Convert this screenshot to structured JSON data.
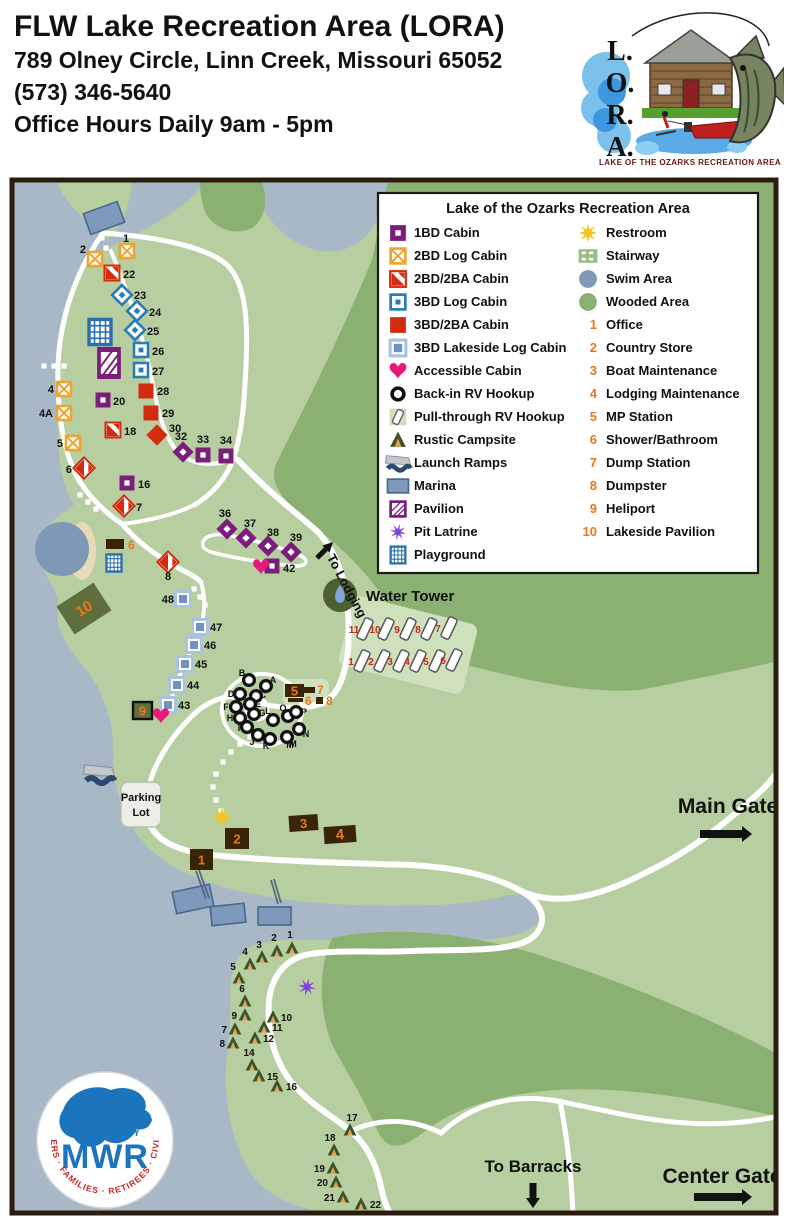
{
  "header": {
    "title": "FLW Lake Recreation Area (LORA)",
    "address": "789 Olney Circle, Linn Creek, Missouri 65052",
    "phone": "(573) 346-5640",
    "hours": "Office Hours Daily 9am - 5pm"
  },
  "lora_logo": {
    "letters": [
      "L.",
      "O.",
      "R.",
      "A."
    ],
    "caption": "LAKE OF THE OZARKS RECREATION AREA"
  },
  "mwr_logo": {
    "org": "U.S. ARMY",
    "name": "MWR",
    "ring_text": "SOLDIERS · FAMILIES · RETIREES · CIVILIANS"
  },
  "colors": {
    "land": "#b7cea0",
    "wooded": "#8bb172",
    "water": "#a8b8c6",
    "road": "#ffffff",
    "purple": "#7b1e7b",
    "orange": "#eda431",
    "red": "#d32b0e",
    "blue": "#2a7cb5",
    "lakeside_frame": "#a9c3e0",
    "lakeside_fill": "#6e93c3",
    "heart": "#e91878",
    "building": "#3a2408",
    "orange_num": "#ee7518",
    "red_num": "#c5281c",
    "olive": "#5e6e3c",
    "sun": "#f3c41d",
    "latrine": "#8040d8",
    "play_blue": "#2d6fae",
    "tower_green": "#4e6033",
    "drop": "#7fa8d8",
    "tent_green": "#3a5326",
    "tent_door": "#e8a05a",
    "pad": "#cfe0bc",
    "beach": "#e8d9b8",
    "swim": "#7d99b5",
    "dock": "#7d99bb"
  },
  "legend": {
    "title": "Lake of the Ozarks Recreation Area",
    "symbols_left": [
      {
        "icon": "cabin-1bd",
        "label": "1BD Cabin"
      },
      {
        "icon": "cabin-2bd",
        "label": "2BD Log Cabin"
      },
      {
        "icon": "cabin-2bd2ba",
        "label": "2BD/2BA Cabin"
      },
      {
        "icon": "cabin-3bd",
        "label": "3BD Log Cabin"
      },
      {
        "icon": "cabin-3bd2ba",
        "label": "3BD/2BA Cabin"
      },
      {
        "icon": "cabin-lakeside",
        "label": "3BD Lakeside Log Cabin"
      },
      {
        "icon": "accessible",
        "label": "Accessible Cabin"
      },
      {
        "icon": "rv-backin",
        "label": "Back-in RV Hookup"
      },
      {
        "icon": "rv-pullthrough",
        "label": "Pull-through RV Hookup"
      },
      {
        "icon": "tent",
        "label": "Rustic Campsite"
      },
      {
        "icon": "launch",
        "label": "Launch Ramps"
      },
      {
        "icon": "marina",
        "label": "Marina"
      },
      {
        "icon": "pavilion",
        "label": "Pavilion"
      },
      {
        "icon": "latrine",
        "label": "Pit Latrine"
      },
      {
        "icon": "playground",
        "label": "Playground"
      }
    ],
    "symbols_right": [
      {
        "icon": "restroom",
        "label": "Restroom"
      },
      {
        "icon": "stairway",
        "label": "Stairway"
      },
      {
        "icon": "swim",
        "label": "Swim Area"
      },
      {
        "icon": "wooded",
        "label": "Wooded Area"
      }
    ],
    "numbered": [
      {
        "n": "1",
        "label": "Office"
      },
      {
        "n": "2",
        "label": "Country Store"
      },
      {
        "n": "3",
        "label": "Boat Maintenance"
      },
      {
        "n": "4",
        "label": "Lodging Maintenance"
      },
      {
        "n": "5",
        "label": "MP Station"
      },
      {
        "n": "6",
        "label": "Shower/Bathroom"
      },
      {
        "n": "7",
        "label": "Dump Station"
      },
      {
        "n": "8",
        "label": "Dumpster"
      },
      {
        "n": "9",
        "label": "Heliport"
      },
      {
        "n": "10",
        "label": "Lakeside Pavilion"
      }
    ]
  },
  "map": {
    "cabins": [
      {
        "n": "1",
        "t": "2bd",
        "x": 127,
        "y": 251,
        "r": 0,
        "lx": 126,
        "ly": 242,
        "la": "middle"
      },
      {
        "n": "2",
        "t": "2bd",
        "x": 95,
        "y": 259,
        "r": 0,
        "lx": 86,
        "ly": 253,
        "la": "end"
      },
      {
        "n": "4",
        "t": "2bd",
        "x": 64,
        "y": 389,
        "r": 0,
        "lx": 54,
        "ly": 393,
        "la": "end"
      },
      {
        "n": "4A",
        "t": "2bd",
        "x": 64,
        "y": 413,
        "r": 0,
        "lx": 53,
        "ly": 417,
        "la": "end"
      },
      {
        "n": "5",
        "t": "2bd",
        "x": 73,
        "y": 443,
        "r": 0,
        "lx": 63,
        "ly": 447,
        "la": "end"
      },
      {
        "n": "22",
        "t": "2bd2ba",
        "x": 112,
        "y": 273,
        "r": 0,
        "lx": 123,
        "ly": 278
      },
      {
        "n": "18",
        "t": "2bd2ba",
        "x": 113,
        "y": 430,
        "r": 0,
        "lx": 124,
        "ly": 435
      },
      {
        "n": "6",
        "t": "2bd2ba",
        "x": 84,
        "y": 468,
        "r": 45,
        "lx": 72,
        "ly": 473,
        "la": "end"
      },
      {
        "n": "7",
        "t": "2bd2ba",
        "x": 124,
        "y": 506,
        "r": 45,
        "lx": 136,
        "ly": 511
      },
      {
        "n": "8",
        "t": "2bd2ba",
        "x": 168,
        "y": 562,
        "r": 45,
        "lx": 168,
        "ly": 580,
        "la": "middle"
      },
      {
        "n": "23",
        "t": "3bd",
        "x": 122,
        "y": 295,
        "r": 45,
        "lx": 134,
        "ly": 299
      },
      {
        "n": "24",
        "t": "3bd",
        "x": 137,
        "y": 311,
        "r": 45,
        "lx": 149,
        "ly": 316
      },
      {
        "n": "25",
        "t": "3bd",
        "x": 135,
        "y": 330,
        "r": 45,
        "lx": 147,
        "ly": 335
      },
      {
        "n": "26",
        "t": "3bd",
        "x": 141,
        "y": 350,
        "r": 0,
        "lx": 152,
        "ly": 355
      },
      {
        "n": "27",
        "t": "3bd",
        "x": 141,
        "y": 370,
        "r": 0,
        "lx": 152,
        "ly": 375
      },
      {
        "n": "28",
        "t": "3bd2ba",
        "x": 146,
        "y": 391,
        "r": 0,
        "lx": 157,
        "ly": 395
      },
      {
        "n": "29",
        "t": "3bd2ba",
        "x": 151,
        "y": 413,
        "r": 0,
        "lx": 162,
        "ly": 417
      },
      {
        "n": "30",
        "t": "3bd2ba",
        "x": 157,
        "y": 435,
        "r": 45,
        "lx": 169,
        "ly": 432
      },
      {
        "n": "20",
        "t": "1bd",
        "x": 103,
        "y": 400,
        "r": 0,
        "lx": 113,
        "ly": 405
      },
      {
        "n": "16",
        "t": "1bd",
        "x": 127,
        "y": 483,
        "r": 0,
        "lx": 138,
        "ly": 488
      },
      {
        "n": "32",
        "t": "1bd",
        "x": 183,
        "y": 452,
        "r": 45,
        "lx": 181,
        "ly": 440,
        "la": "middle"
      },
      {
        "n": "33",
        "t": "1bd",
        "x": 203,
        "y": 455,
        "r": 0,
        "lx": 203,
        "ly": 443,
        "la": "middle"
      },
      {
        "n": "34",
        "t": "1bd",
        "x": 226,
        "y": 456,
        "r": 0,
        "lx": 226,
        "ly": 444,
        "la": "middle"
      },
      {
        "n": "36",
        "t": "1bd",
        "x": 227,
        "y": 529,
        "r": 45,
        "lx": 225,
        "ly": 517,
        "la": "middle"
      },
      {
        "n": "37",
        "t": "1bd",
        "x": 246,
        "y": 538,
        "r": 45,
        "lx": 250,
        "ly": 527,
        "la": "middle"
      },
      {
        "n": "38",
        "t": "1bd",
        "x": 268,
        "y": 546,
        "r": 45,
        "lx": 273,
        "ly": 536,
        "la": "middle"
      },
      {
        "n": "39",
        "t": "1bd",
        "x": 291,
        "y": 552,
        "r": 45,
        "lx": 296,
        "ly": 541,
        "la": "middle"
      },
      {
        "n": "42",
        "t": "1bd",
        "x": 272,
        "y": 566,
        "r": 0,
        "lx": 283,
        "ly": 572
      },
      {
        "n": "48",
        "t": "lakeside",
        "x": 183,
        "y": 599,
        "r": 0,
        "lx": 174,
        "ly": 603,
        "la": "end"
      },
      {
        "n": "47",
        "t": "lakeside",
        "x": 200,
        "y": 627,
        "r": 0,
        "lx": 210,
        "ly": 631
      },
      {
        "n": "46",
        "t": "lakeside",
        "x": 194,
        "y": 645,
        "r": 0,
        "lx": 204,
        "ly": 649
      },
      {
        "n": "45",
        "t": "lakeside",
        "x": 185,
        "y": 664,
        "r": 0,
        "lx": 195,
        "ly": 668
      },
      {
        "n": "44",
        "t": "lakeside",
        "x": 177,
        "y": 685,
        "r": 0,
        "lx": 187,
        "ly": 689
      },
      {
        "n": "43",
        "t": "lakeside",
        "x": 168,
        "y": 705,
        "r": 0,
        "lx": 178,
        "ly": 709
      }
    ],
    "hearts": [
      {
        "x": 261,
        "y": 567
      },
      {
        "x": 161,
        "y": 716
      }
    ],
    "rv_backin": [
      {
        "l": "B",
        "x": 249,
        "y": 680,
        "lx": 242,
        "ly": 676
      },
      {
        "l": "A",
        "x": 266,
        "y": 686,
        "lx": 273,
        "ly": 683
      },
      {
        "l": "D",
        "x": 240,
        "y": 694,
        "lx": 231,
        "ly": 697
      },
      {
        "l": "C",
        "x": 256,
        "y": 696,
        "lx": 263,
        "ly": 698
      },
      {
        "l": "F",
        "x": 236,
        "y": 707,
        "lx": 226,
        "ly": 710
      },
      {
        "l": "E",
        "x": 250,
        "y": 704,
        "lx": 258,
        "ly": 707
      },
      {
        "l": "H",
        "x": 240,
        "y": 718,
        "lx": 230,
        "ly": 721
      },
      {
        "l": "G",
        "x": 254,
        "y": 714,
        "lx": 262,
        "ly": 716
      },
      {
        "l": "I",
        "x": 247,
        "y": 727,
        "lx": 239,
        "ly": 731
      },
      {
        "l": "L",
        "x": 273,
        "y": 720,
        "lx": 268,
        "ly": 714
      },
      {
        "l": "Q",
        "x": 288,
        "y": 716,
        "lx": 283,
        "ly": 711
      },
      {
        "l": "P",
        "x": 296,
        "y": 712,
        "lx": 304,
        "ly": 715
      },
      {
        "l": "J",
        "x": 258,
        "y": 735,
        "lx": 252,
        "ly": 745
      },
      {
        "l": "K",
        "x": 270,
        "y": 739,
        "lx": 266,
        "ly": 749
      },
      {
        "l": "M",
        "x": 287,
        "y": 737,
        "lx": 293,
        "ly": 747
      },
      {
        "l": "N",
        "x": 299,
        "y": 729,
        "lx": 306,
        "ly": 737
      }
    ],
    "rv_pullthrough": [
      {
        "n": "11",
        "x": 365,
        "y": 629
      },
      {
        "n": "10",
        "x": 386,
        "y": 629
      },
      {
        "n": "9",
        "x": 408,
        "y": 629
      },
      {
        "n": "8",
        "x": 429,
        "y": 629
      },
      {
        "n": "7",
        "x": 449,
        "y": 628
      },
      {
        "n": "1",
        "x": 362,
        "y": 661
      },
      {
        "n": "2",
        "x": 382,
        "y": 661
      },
      {
        "n": "3",
        "x": 401,
        "y": 661
      },
      {
        "n": "4",
        "x": 418,
        "y": 661
      },
      {
        "n": "5",
        "x": 437,
        "y": 661
      },
      {
        "n": "6",
        "x": 454,
        "y": 660
      }
    ],
    "tents": [
      {
        "n": "1",
        "x": 292,
        "y": 948,
        "lx": 290,
        "ly": 938,
        "la": "middle"
      },
      {
        "n": "2",
        "x": 277,
        "y": 951,
        "lx": 274,
        "ly": 941,
        "la": "middle"
      },
      {
        "n": "3",
        "x": 262,
        "y": 957,
        "lx": 259,
        "ly": 948,
        "la": "middle"
      },
      {
        "n": "4",
        "x": 250,
        "y": 964,
        "lx": 245,
        "ly": 955,
        "la": "middle"
      },
      {
        "n": "5",
        "x": 239,
        "y": 978,
        "lx": 233,
        "ly": 970,
        "la": "middle"
      },
      {
        "n": "6",
        "x": 245,
        "y": 1001,
        "lx": 242,
        "ly": 992,
        "la": "middle"
      },
      {
        "n": "9",
        "x": 245,
        "y": 1015,
        "lx": 237,
        "ly": 1019,
        "la": "end"
      },
      {
        "n": "10",
        "x": 273,
        "y": 1017,
        "lx": 281,
        "ly": 1021
      },
      {
        "n": "7",
        "x": 235,
        "y": 1029,
        "lx": 227,
        "ly": 1033,
        "la": "end"
      },
      {
        "n": "11",
        "x": 264,
        "y": 1027,
        "lx": 272,
        "ly": 1031
      },
      {
        "n": "12",
        "x": 255,
        "y": 1038,
        "lx": 263,
        "ly": 1042
      },
      {
        "n": "8",
        "x": 233,
        "y": 1043,
        "lx": 225,
        "ly": 1047,
        "la": "end"
      },
      {
        "n": "14",
        "x": 252,
        "y": 1065,
        "lx": 249,
        "ly": 1056,
        "la": "middle"
      },
      {
        "n": "15",
        "x": 259,
        "y": 1076,
        "lx": 267,
        "ly": 1080
      },
      {
        "n": "16",
        "x": 277,
        "y": 1086,
        "lx": 286,
        "ly": 1090
      },
      {
        "n": "17",
        "x": 350,
        "y": 1130,
        "lx": 352,
        "ly": 1121,
        "la": "middle"
      },
      {
        "n": "18",
        "x": 334,
        "y": 1150,
        "lx": 330,
        "ly": 1141,
        "la": "middle"
      },
      {
        "n": "19",
        "x": 333,
        "y": 1168,
        "lx": 325,
        "ly": 1172,
        "la": "end"
      },
      {
        "n": "20",
        "x": 336,
        "y": 1182,
        "lx": 328,
        "ly": 1186,
        "la": "end"
      },
      {
        "n": "21",
        "x": 343,
        "y": 1197,
        "lx": 335,
        "ly": 1201,
        "la": "end"
      },
      {
        "n": "22",
        "x": 361,
        "y": 1204,
        "lx": 370,
        "ly": 1208
      }
    ],
    "facilities": [
      {
        "n": "1",
        "x": 190,
        "y": 849,
        "w": 23,
        "h": 21,
        "inside": true
      },
      {
        "n": "2",
        "x": 225,
        "y": 828,
        "w": 24,
        "h": 21,
        "inside": true
      },
      {
        "n": "3",
        "x": 289,
        "y": 815,
        "w": 29,
        "h": 16,
        "rot": -4,
        "inside": true
      },
      {
        "n": "4",
        "x": 324,
        "y": 826,
        "w": 32,
        "h": 17,
        "rot": -4,
        "inside": true
      },
      {
        "n": "5",
        "x": 285,
        "y": 684,
        "w": 19,
        "h": 13,
        "inside": true
      },
      {
        "n": "7",
        "x": 304,
        "y": 687,
        "w": 11,
        "h": 6,
        "lx": 317,
        "ly": 694
      },
      {
        "n": "6",
        "x": 288,
        "y": 698,
        "w": 15,
        "h": 4,
        "lx": 305,
        "ly": 705
      },
      {
        "n": "8",
        "x": 316,
        "y": 697,
        "w": 7,
        "h": 7,
        "lx": 326,
        "ly": 705
      },
      {
        "n": "6",
        "x": 106,
        "y": 539,
        "w": 18,
        "h": 10,
        "lx": 128,
        "ly": 549
      },
      {
        "n": "9",
        "x": 133,
        "y": 702,
        "w": 19,
        "h": 17,
        "variant": "heliport",
        "inside": true
      },
      {
        "n": "10",
        "x": 62,
        "y": 592,
        "w": 44,
        "h": 33,
        "rot": -33,
        "variant": "olive",
        "inside": true
      }
    ],
    "labels": [
      {
        "text": "Water Tower",
        "x": 366,
        "y": 601,
        "size": 15
      },
      {
        "text": "Main Gate",
        "x": 728,
        "y": 813,
        "size": 21,
        "la": "middle"
      },
      {
        "text": "Center Gate",
        "x": 722,
        "y": 1183,
        "size": 21,
        "la": "middle"
      },
      {
        "text": "To Barracks",
        "x": 533,
        "y": 1172,
        "size": 17,
        "la": "middle"
      },
      {
        "text": "To Lodging",
        "x": 343,
        "y": 588,
        "size": 13,
        "la": "middle",
        "rot": 62
      },
      {
        "text": "M",
        "x": 290,
        "y": 748,
        "size": 9,
        "la": "middle",
        "plain": true
      }
    ],
    "parking": {
      "x": 121,
      "y": 782,
      "w": 40,
      "h": 45,
      "lines": [
        "Parking",
        "Lot"
      ]
    },
    "arrows": [
      {
        "name": "main-gate-arrow",
        "x1": 700,
        "y1": 834,
        "x2": 752,
        "y2": 834,
        "w": 8
      },
      {
        "name": "center-gate-arrow",
        "x1": 694,
        "y1": 1197,
        "x2": 752,
        "y2": 1197,
        "w": 8
      },
      {
        "name": "to-barracks-arrow",
        "x1": 533,
        "y1": 1183,
        "x2": 533,
        "y2": 1208,
        "w": 7
      },
      {
        "name": "to-lodging-arrow",
        "x1": 317,
        "y1": 558,
        "x2": 333,
        "y2": 542,
        "w": 5
      }
    ],
    "stairways": [
      [
        [
          94,
          216
        ],
        [
          98,
          227
        ],
        [
          102,
          238
        ],
        [
          106,
          248
        ]
      ],
      [
        [
          44,
          366
        ],
        [
          54,
          366
        ],
        [
          64,
          366
        ]
      ],
      [
        [
          80,
          495
        ],
        [
          88,
          502
        ],
        [
          96,
          509
        ]
      ],
      [
        [
          194,
          589
        ],
        [
          200,
          597
        ],
        [
          205,
          605
        ]
      ],
      [
        [
          250,
          737
        ],
        [
          240,
          744
        ],
        [
          231,
          752
        ],
        [
          223,
          762
        ],
        [
          216,
          774
        ],
        [
          213,
          787
        ],
        [
          216,
          800
        ],
        [
          221,
          811
        ]
      ]
    ],
    "water_tower_label_icon": {
      "x": 340,
      "y": 595,
      "r": 17
    },
    "swim": {
      "x": 62,
      "y": 549,
      "r": 27
    },
    "restroom": {
      "x": 222,
      "y": 817
    },
    "latrine": {
      "x": 307,
      "y": 987
    },
    "playgrounds": [
      {
        "x": 100,
        "y": 332,
        "w": 22,
        "h": 26
      },
      {
        "x": 114,
        "y": 563,
        "w": 15,
        "h": 16
      }
    ],
    "pavilions": [
      {
        "x": 109,
        "y": 363,
        "w": 20,
        "h": 27
      }
    ],
    "marina_rects": [
      {
        "x": 86,
        "y": 207,
        "w": 36,
        "h": 22,
        "rot": -20
      },
      {
        "x": 174,
        "y": 888,
        "w": 38,
        "h": 22,
        "rot": -12
      },
      {
        "x": 211,
        "y": 905,
        "w": 34,
        "h": 19,
        "rot": -6
      },
      {
        "x": 258,
        "y": 907,
        "w": 33,
        "h": 18,
        "rot": 0
      }
    ]
  }
}
